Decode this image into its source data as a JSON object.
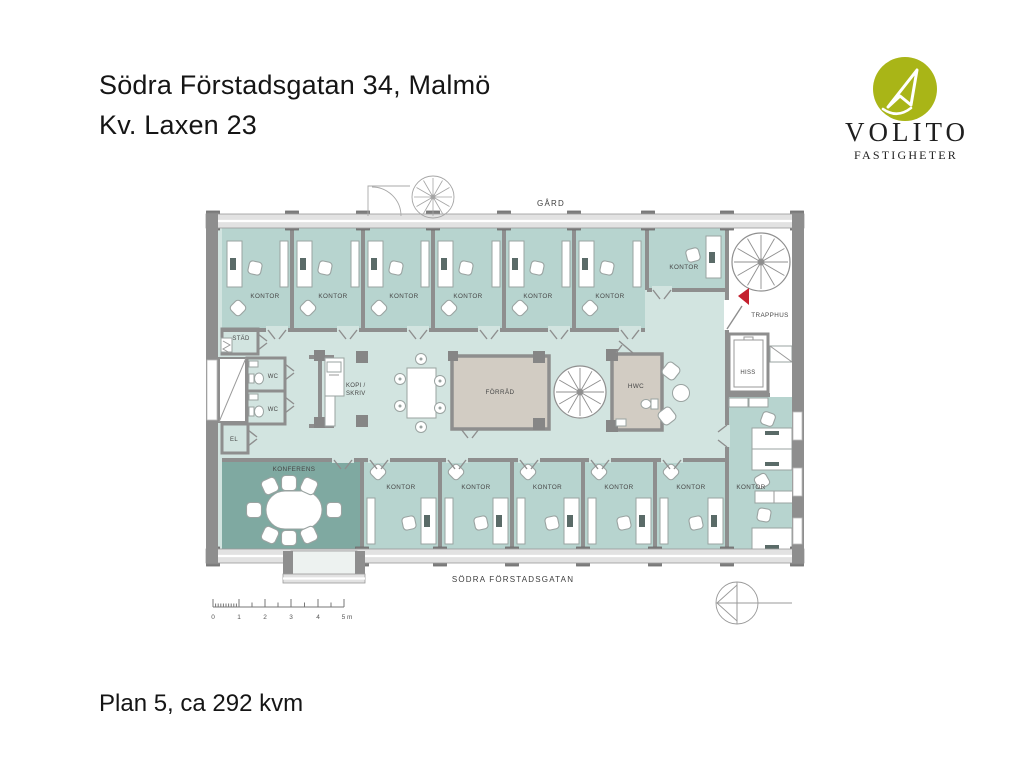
{
  "page": {
    "title_line1": "Södra Förstadsgatan 34, Malmö",
    "title_line2": "Kv. Laxen 23",
    "plan_caption": "Plan 5, ca 292 kvm"
  },
  "logo": {
    "company": "VOLITO",
    "division": "FASTIGHETER",
    "brand_color": "#a9b517"
  },
  "floorplan": {
    "courtyard_label": "GÅRD",
    "street_label": "SÖDRA FÖRSTADSGATAN",
    "stairwell_label": "TRAPPHUS",
    "elevator_label": "HISS",
    "rooms": {
      "office": "KONTOR",
      "conference": "KONFERENS",
      "storage": "FÖRRÅD",
      "cleaning": "STÄD",
      "wc": "WC",
      "accessible_wc": "HWC",
      "electrical": "EL",
      "copy_line1": "KOPI /",
      "copy_line2": "SKRIV"
    },
    "scale_bar": {
      "unit_labels": [
        "0",
        "1",
        "2",
        "3",
        "4",
        "5 m"
      ]
    },
    "colors": {
      "office_fill": "#b7d4cf",
      "corridor_fill": "#d2e4e0",
      "conference_fill": "#7fa9a1",
      "service_room_fill": "#d2ccc3",
      "stairwell_fill": "#ffffff",
      "wall": "#8e8e8e",
      "entrance_marker": "#c4202e"
    }
  }
}
